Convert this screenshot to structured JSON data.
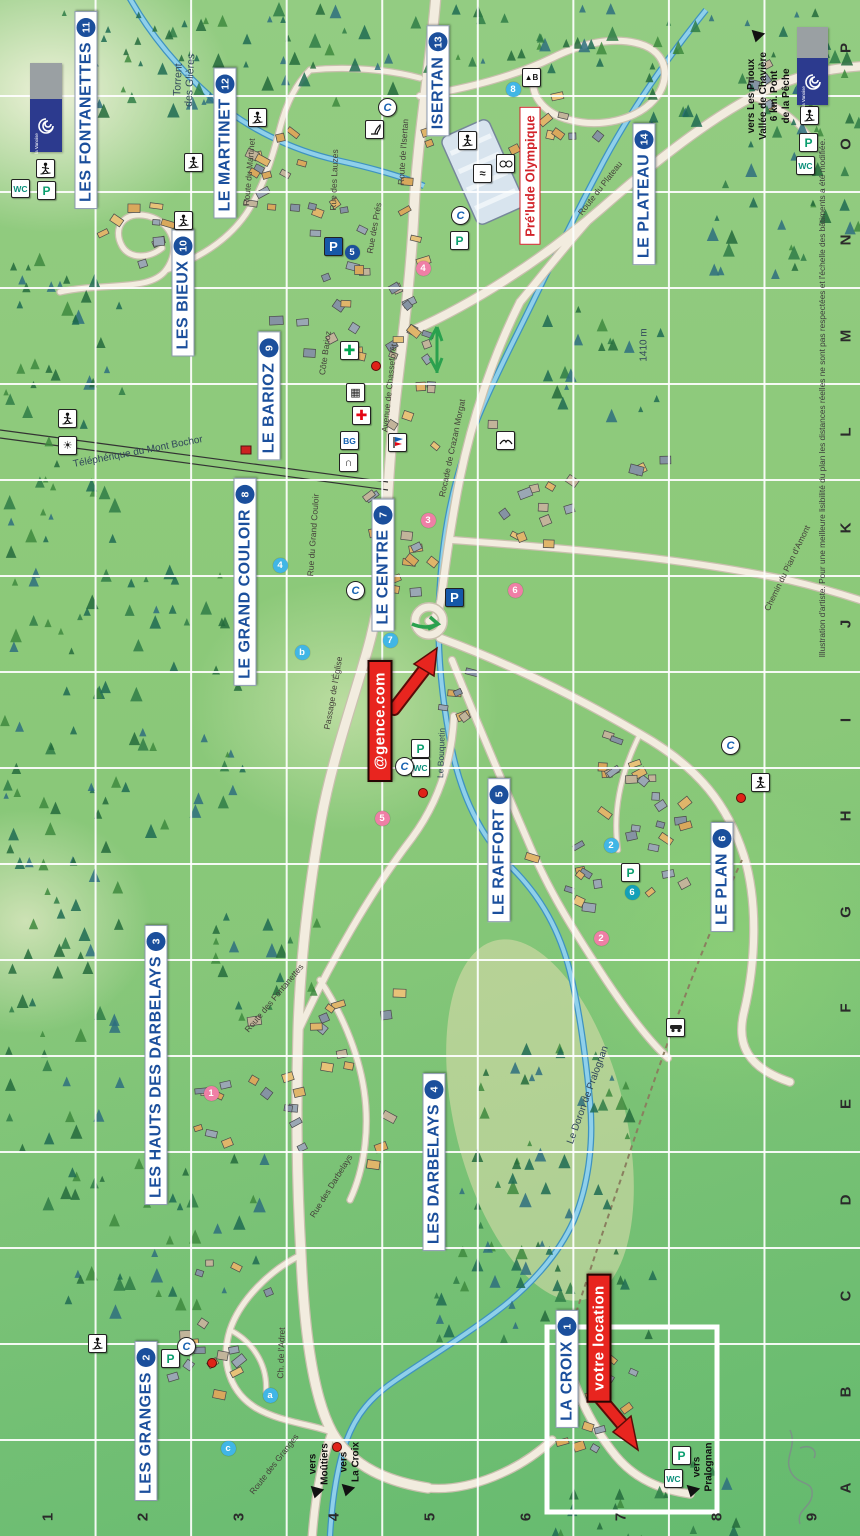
{
  "fine_print": "Illustration d'artiste. Pour une meilleure lisibilité du plan les distances réelles ne sont pas respectées et l'échelle des bâtiments a été modifiée.",
  "axis": {
    "cols": [
      "1",
      "2",
      "3",
      "4",
      "5",
      "6",
      "7",
      "8",
      "9"
    ],
    "rows": [
      "P",
      "O",
      "N",
      "M",
      "L",
      "K",
      "J",
      "I",
      "H",
      "G",
      "F",
      "E",
      "D",
      "C",
      "B",
      "A"
    ]
  },
  "districts": [
    {
      "label": "LA CROIX",
      "badge": "1",
      "x": 567,
      "y": 1369
    },
    {
      "label": "LES GRANGES",
      "badge": "2",
      "x": 146,
      "y": 1421
    },
    {
      "label": "LES HAUTS DES DARBELAYS",
      "badge": "3",
      "x": 156,
      "y": 1065
    },
    {
      "label": "LES DARBELAYS",
      "badge": "4",
      "x": 434,
      "y": 1162
    },
    {
      "label": "LE RAFFORT",
      "badge": "5",
      "x": 499,
      "y": 850
    },
    {
      "label": "LE PLAN",
      "badge": "6",
      "x": 722,
      "y": 877
    },
    {
      "label": "LE CENTRE",
      "badge": "7",
      "x": 383,
      "y": 565
    },
    {
      "label": "LE GRAND COULOIR",
      "badge": "8",
      "x": 245,
      "y": 582
    },
    {
      "label": "LE BARIOZ",
      "badge": "9",
      "x": 269,
      "y": 396
    },
    {
      "label": "LES BIEUX",
      "badge": "10",
      "x": 183,
      "y": 293
    },
    {
      "label": "LES FONTANETTES",
      "badge": "11",
      "x": 86,
      "y": 110
    },
    {
      "label": "LE MARTINET",
      "badge": "12",
      "x": 225,
      "y": 143
    },
    {
      "label": "ISERTAN",
      "badge": "13",
      "x": 438,
      "y": 81
    },
    {
      "label": "LE PLATEAU",
      "badge": "14",
      "x": 644,
      "y": 194
    }
  ],
  "event_label": {
    "text": "Pré'lude Olympique",
    "x": 530,
    "y": 176
  },
  "ad_labels": [
    {
      "text": "@gence.com",
      "x": 380,
      "y": 721,
      "arrow": {
        "shaft": [
          394,
          709,
          424,
          670
        ],
        "head": [
          [
            437,
            648
          ],
          [
            434,
            676
          ],
          [
            414,
            664
          ]
        ]
      }
    },
    {
      "text": "votre location",
      "x": 599,
      "y": 1338,
      "arrow": {
        "shaft": [
          600,
          1398,
          622,
          1424
        ],
        "head": [
          [
            638,
            1450
          ],
          [
            631,
            1416
          ],
          [
            613,
            1432
          ]
        ]
      }
    }
  ],
  "place_labels": [
    {
      "text": "Torrent\ndes Glières",
      "x": 184,
      "y": 80,
      "rot": -87,
      "size": 10.5
    },
    {
      "text": "Téléphérique du Mont Bochor",
      "x": 138,
      "y": 452,
      "rot": -11,
      "size": 10
    },
    {
      "text": "1410 m",
      "x": 644,
      "y": 345,
      "rot": -90,
      "size": 10
    },
    {
      "text": "Le Bouquetin",
      "x": 441,
      "y": 753,
      "rot": -88,
      "size": 8.5
    },
    {
      "text": "Le Doron de Pralognan",
      "x": 588,
      "y": 1095,
      "rot": -70,
      "size": 10
    }
  ],
  "road_labels": [
    {
      "text": "Route du Plateau",
      "x": 600,
      "y": 188,
      "rot": -52
    },
    {
      "text": "Route de l'Isertan",
      "x": 403,
      "y": 152,
      "rot": -86
    },
    {
      "text": "Rue des Lauzes",
      "x": 334,
      "y": 180,
      "rot": -88
    },
    {
      "text": "Rue des Prés",
      "x": 374,
      "y": 228,
      "rot": -80
    },
    {
      "text": "Route du Martinet",
      "x": 249,
      "y": 172,
      "rot": -85
    },
    {
      "text": "Côte Barioz",
      "x": 325,
      "y": 353,
      "rot": -82
    },
    {
      "text": "Avenue de Chasseforêt",
      "x": 389,
      "y": 388,
      "rot": -84
    },
    {
      "text": "Rocade de Crazan Morgat",
      "x": 452,
      "y": 448,
      "rot": -78
    },
    {
      "text": "Rue du Grand Couloir",
      "x": 313,
      "y": 535,
      "rot": -86
    },
    {
      "text": "Chemin du Pian d'Amont",
      "x": 787,
      "y": 568,
      "rot": -64
    },
    {
      "text": "Passage de l'Église",
      "x": 333,
      "y": 693,
      "rot": -80
    },
    {
      "text": "Route des Fontanettes",
      "x": 274,
      "y": 998,
      "rot": -50
    },
    {
      "text": "Rue des Darbelays",
      "x": 331,
      "y": 1186,
      "rot": -58
    },
    {
      "text": "Ch. de l'Adret",
      "x": 281,
      "y": 1353,
      "rot": -88
    },
    {
      "text": "Route des Granges",
      "x": 274,
      "y": 1464,
      "rot": -52
    }
  ],
  "direction_signs": [
    {
      "lines": "vers\nMoûtiers",
      "x": 319,
      "y": 1464,
      "tri": [
        316,
        1493
      ]
    },
    {
      "lines": "vers\nLa Croix",
      "x": 350,
      "y": 1462,
      "tri": [
        347,
        1491
      ]
    },
    {
      "lines": "vers\nPralognan",
      "x": 703,
      "y": 1467,
      "tri": [
        692,
        1492
      ]
    },
    {
      "lines": "vers Les Prioux\nVallée de Chavière\n6 km. Pont\nde la Pêche",
      "x": 769,
      "y": 96,
      "tri": [
        757,
        37
      ]
    }
  ],
  "small_badges": [
    {
      "t": "8",
      "c": "lb",
      "x": 513,
      "y": 89
    },
    {
      "t": "5",
      "c": "db",
      "x": 352,
      "y": 252
    },
    {
      "t": "4",
      "c": "pk",
      "x": 423,
      "y": 268
    },
    {
      "t": "3",
      "c": "pk",
      "x": 428,
      "y": 520
    },
    {
      "t": "4",
      "c": "lb",
      "x": 280,
      "y": 565
    },
    {
      "t": "b",
      "c": "lb",
      "x": 302,
      "y": 652
    },
    {
      "t": "7",
      "c": "lb",
      "x": 390,
      "y": 640
    },
    {
      "t": "6",
      "c": "pk",
      "x": 515,
      "y": 590
    },
    {
      "t": "5",
      "c": "pk",
      "x": 382,
      "y": 818
    },
    {
      "t": "2",
      "c": "lb",
      "x": 611,
      "y": 845
    },
    {
      "t": "6",
      "c": "tl",
      "x": 632,
      "y": 892
    },
    {
      "t": "2",
      "c": "pk",
      "x": 601,
      "y": 938
    },
    {
      "t": "1",
      "c": "pk",
      "x": 211,
      "y": 1093
    },
    {
      "t": "a",
      "c": "lb",
      "x": 270,
      "y": 1395
    },
    {
      "t": "c",
      "c": "lb",
      "x": 228,
      "y": 1448
    }
  ],
  "icons": [
    {
      "type": "wc",
      "x": 20,
      "y": 188
    },
    {
      "type": "wc",
      "x": 805,
      "y": 165
    },
    {
      "type": "wc",
      "x": 420,
      "y": 767
    },
    {
      "type": "wc",
      "x": 673,
      "y": 1478
    },
    {
      "type": "p",
      "x": 46,
      "y": 190
    },
    {
      "type": "p",
      "x": 808,
      "y": 142
    },
    {
      "type": "p",
      "x": 459,
      "y": 240
    },
    {
      "type": "p",
      "x": 420,
      "y": 748
    },
    {
      "type": "p",
      "x": 630,
      "y": 872
    },
    {
      "type": "p",
      "x": 170,
      "y": 1358
    },
    {
      "type": "p",
      "x": 681,
      "y": 1455
    },
    {
      "type": "P",
      "x": 333,
      "y": 246
    },
    {
      "type": "P",
      "x": 454,
      "y": 597
    },
    {
      "type": "tel",
      "x": 387,
      "y": 107
    },
    {
      "type": "tel",
      "x": 460,
      "y": 215
    },
    {
      "type": "tel",
      "x": 355,
      "y": 590
    },
    {
      "type": "tel",
      "x": 404,
      "y": 766
    },
    {
      "type": "tel",
      "x": 730,
      "y": 745
    },
    {
      "type": "tel",
      "x": 186,
      "y": 1346
    },
    {
      "type": "ph+",
      "x": 349,
      "y": 350
    },
    {
      "type": "med+",
      "x": 361,
      "y": 415
    },
    {
      "type": "bg",
      "x": 349,
      "y": 440
    },
    {
      "type": "bank",
      "x": 355,
      "y": 392
    },
    {
      "type": "arch",
      "x": 348,
      "y": 462
    },
    {
      "type": "flag",
      "x": 397,
      "y": 442
    },
    {
      "type": "bird",
      "x": 505,
      "y": 440
    },
    {
      "type": "ski",
      "x": 45,
      "y": 168
    },
    {
      "type": "ski",
      "x": 193,
      "y": 162
    },
    {
      "type": "ski",
      "x": 183,
      "y": 220
    },
    {
      "type": "ski",
      "x": 257,
      "y": 117
    },
    {
      "type": "ski",
      "x": 67,
      "y": 418
    },
    {
      "type": "ski",
      "x": 809,
      "y": 115
    },
    {
      "type": "ski",
      "x": 760,
      "y": 782
    },
    {
      "type": "ski",
      "x": 97,
      "y": 1343
    },
    {
      "type": "sun",
      "x": 67,
      "y": 445
    },
    {
      "type": "ibex",
      "x": 374,
      "y": 129
    },
    {
      "type": "skate",
      "x": 467,
      "y": 140
    },
    {
      "type": "faces",
      "x": 505,
      "y": 163
    },
    {
      "type": "waves",
      "x": 482,
      "y": 173
    },
    {
      "type": "car",
      "x": 675,
      "y": 1027
    },
    {
      "type": "signb",
      "x": 531,
      "y": 77
    }
  ],
  "red_dots": [
    {
      "x": 375,
      "y": 365
    },
    {
      "x": 422,
      "y": 792
    },
    {
      "x": 740,
      "y": 797
    },
    {
      "x": 211,
      "y": 1362
    },
    {
      "x": 336,
      "y": 1446
    }
  ],
  "logos": [
    {
      "x": 30,
      "y": 63,
      "w": 32,
      "h": 89,
      "text": "la Vanoise"
    },
    {
      "x": 797,
      "y": 27,
      "w": 31,
      "h": 78,
      "text": "la Vanoise"
    }
  ],
  "inset_frame": {
    "x": 547,
    "y": 1327,
    "w": 170,
    "h": 185
  },
  "colors": {
    "district_text": "#1b4f9c",
    "badge_dark": "#1b4f9c",
    "badge_light": "#41b6e6",
    "badge_teal": "#13a0b8",
    "badge_pink": "#ef7fa6",
    "ad_red": "#e8251f",
    "event_red": "#d2232a",
    "road_fill": "#f2ecdf",
    "road_casing": "#c9c0ae",
    "river": "#8fd0ea",
    "river_edge": "#3f93c0",
    "grid": "#ffffff",
    "pharmacy_green": "#00a651",
    "parking_blue": "#1658a8",
    "wc_green": "#0a8f7a"
  },
  "map_art": {
    "roads": [
      {
        "d": "M436,-5 C430,70 417,140 414,210 C411,275 403,335 396,395 C391,440 388,485 386,530 C384,575 378,612 368,648 C352,705 332,760 321,820 C309,888 300,960 298,1032 C296,1105 297,1185 301,1255 C304,1325 312,1395 332,1432 C352,1468 390,1482 428,1488",
        "w": 9
      },
      {
        "d": "M332,1432 C322,1460 315,1495 312,1540",
        "w": 7
      },
      {
        "d": "M428,1488 C470,1492 520,1470 552,1440",
        "w": 7
      },
      {
        "d": "M560,1332 C570,1380 588,1422 616,1456 C636,1480 662,1490 690,1494",
        "w": 7
      },
      {
        "d": "M414,330 C470,305 540,262 602,208 C652,164 705,122 752,97 C792,76 828,68 865,66",
        "w": 8
      },
      {
        "d": "M752,97 C780,105 798,122 812,140",
        "w": 5
      },
      {
        "d": "M520,302 C492,358 472,420 460,478 C452,518 446,560 441,600 C438,615 434,620 429,621",
        "w": 7
      },
      {
        "d": "M520,302 C545,272 570,240 592,216",
        "w": 7
      },
      {
        "d": "M452,540 C560,548 672,556 788,580 C818,587 842,594 866,602",
        "w": 6
      },
      {
        "d": "M440,638 C505,662 572,694 640,734 C700,768 728,806 744,856 C758,902 756,962 744,1012 C736,1045 748,1068 790,1082",
        "w": 7
      },
      {
        "d": "M452,660 C480,730 506,790 530,846 C552,898 580,940 606,980 C630,1016 650,1042 668,1058",
        "w": 6
      },
      {
        "d": "M298,1032 C330,962 372,890 412,838 C440,800 452,758 454,716",
        "w": 6
      },
      {
        "d": "M60,292 C105,282 150,292 166,270 C182,248 172,222 148,216 C124,210 112,228 122,246 C130,260 150,258 162,248",
        "w": 5
      },
      {
        "d": "M166,270 C200,258 228,240 246,214 C262,190 272,160 280,128 C286,104 296,84 310,70",
        "w": 5
      },
      {
        "d": "M310,70 C350,66 390,70 420,78",
        "w": 5
      },
      {
        "d": "M420,96 C470,88 515,76 552,58 C580,44 612,36 640,44 C668,52 672,80 654,100 C636,120 600,128 570,120 C545,114 530,96 534,78",
        "w": 6
      },
      {
        "d": "M301,1255 C270,1270 240,1300 230,1330 C220,1362 230,1392 256,1408 C280,1422 310,1424 332,1432",
        "w": 5
      },
      {
        "d": "M230,1330 C250,1340 268,1362 266,1392",
        "w": 4
      },
      {
        "d": "M320,980 C340,1010 358,1050 364,1090 C370,1130 364,1170 350,1200",
        "w": 5
      },
      {
        "d": "M640,734 C622,770 612,810 618,850",
        "w": 4
      }
    ],
    "trails": [
      "M742,860 C700,950 660,1060 624,1170 C600,1240 580,1300 566,1344"
    ],
    "rivers": [
      "M706,10 C664,62 628,114 598,172 C568,228 544,280 518,332 C494,380 470,430 457,478 C447,514 441,556 439,602 C437,652 442,702 452,750 C462,798 482,838 512,868 C542,898 560,932 570,972 C580,1012 586,1060 590,1102 C594,1144 588,1186 574,1220 C558,1256 528,1288 496,1312 C462,1338 428,1358 396,1380 C372,1396 356,1414 346,1442 C338,1464 332,1498 330,1536",
      "M128,-5 C150,35 178,68 212,98 C246,128 292,150 336,160 C372,168 402,176 424,186"
    ],
    "cablecar": {
      "x1": 0,
      "y1": 430,
      "x2": 388,
      "y2": 482,
      "cabin": [
        246,
        450
      ]
    },
    "rink": {
      "x": 483,
      "y": 172,
      "w": 52,
      "h": 96,
      "rot": -24
    },
    "roundabout": {
      "x": 429,
      "y": 621,
      "r": 14
    },
    "sand": {
      "x": 540,
      "y": 1120,
      "rx": 85,
      "ry": 185,
      "rot": -14
    },
    "building_clusters": [
      [
        140,
        235,
        55,
        55,
        10
      ],
      [
        262,
        165,
        45,
        75,
        14
      ],
      [
        330,
        285,
        60,
        95,
        20
      ],
      [
        408,
        300,
        35,
        190,
        24
      ],
      [
        385,
        560,
        55,
        75,
        16
      ],
      [
        545,
        495,
        65,
        85,
        12
      ],
      [
        662,
        825,
        75,
        80,
        18
      ],
      [
        565,
        880,
        55,
        50,
        9
      ],
      [
        330,
        1080,
        85,
        105,
        22
      ],
      [
        215,
        1115,
        35,
        55,
        7
      ],
      [
        225,
        1330,
        75,
        75,
        16
      ],
      [
        598,
        1400,
        48,
        55,
        13
      ],
      [
        560,
        115,
        55,
        50,
        9
      ],
      [
        768,
        92,
        28,
        38,
        5
      ],
      [
        640,
        485,
        35,
        35,
        3
      ],
      [
        470,
        700,
        40,
        40,
        6
      ],
      [
        610,
        760,
        50,
        40,
        8
      ]
    ],
    "tree_zones": [
      [
        60,
        0,
        330,
        110,
        55
      ],
      [
        410,
        0,
        200,
        70,
        25
      ],
      [
        640,
        0,
        220,
        130,
        40
      ],
      [
        0,
        250,
        120,
        400,
        60
      ],
      [
        120,
        550,
        120,
        280,
        35
      ],
      [
        0,
        680,
        115,
        540,
        70
      ],
      [
        60,
        1140,
        200,
        170,
        35
      ],
      [
        430,
        1170,
        230,
        170,
        45
      ],
      [
        470,
        1040,
        170,
        140,
        28
      ],
      [
        700,
        130,
        160,
        150,
        25
      ],
      [
        200,
        900,
        120,
        120,
        18
      ],
      [
        540,
        300,
        120,
        120,
        18
      ],
      [
        540,
        1440,
        200,
        96,
        18
      ]
    ]
  }
}
